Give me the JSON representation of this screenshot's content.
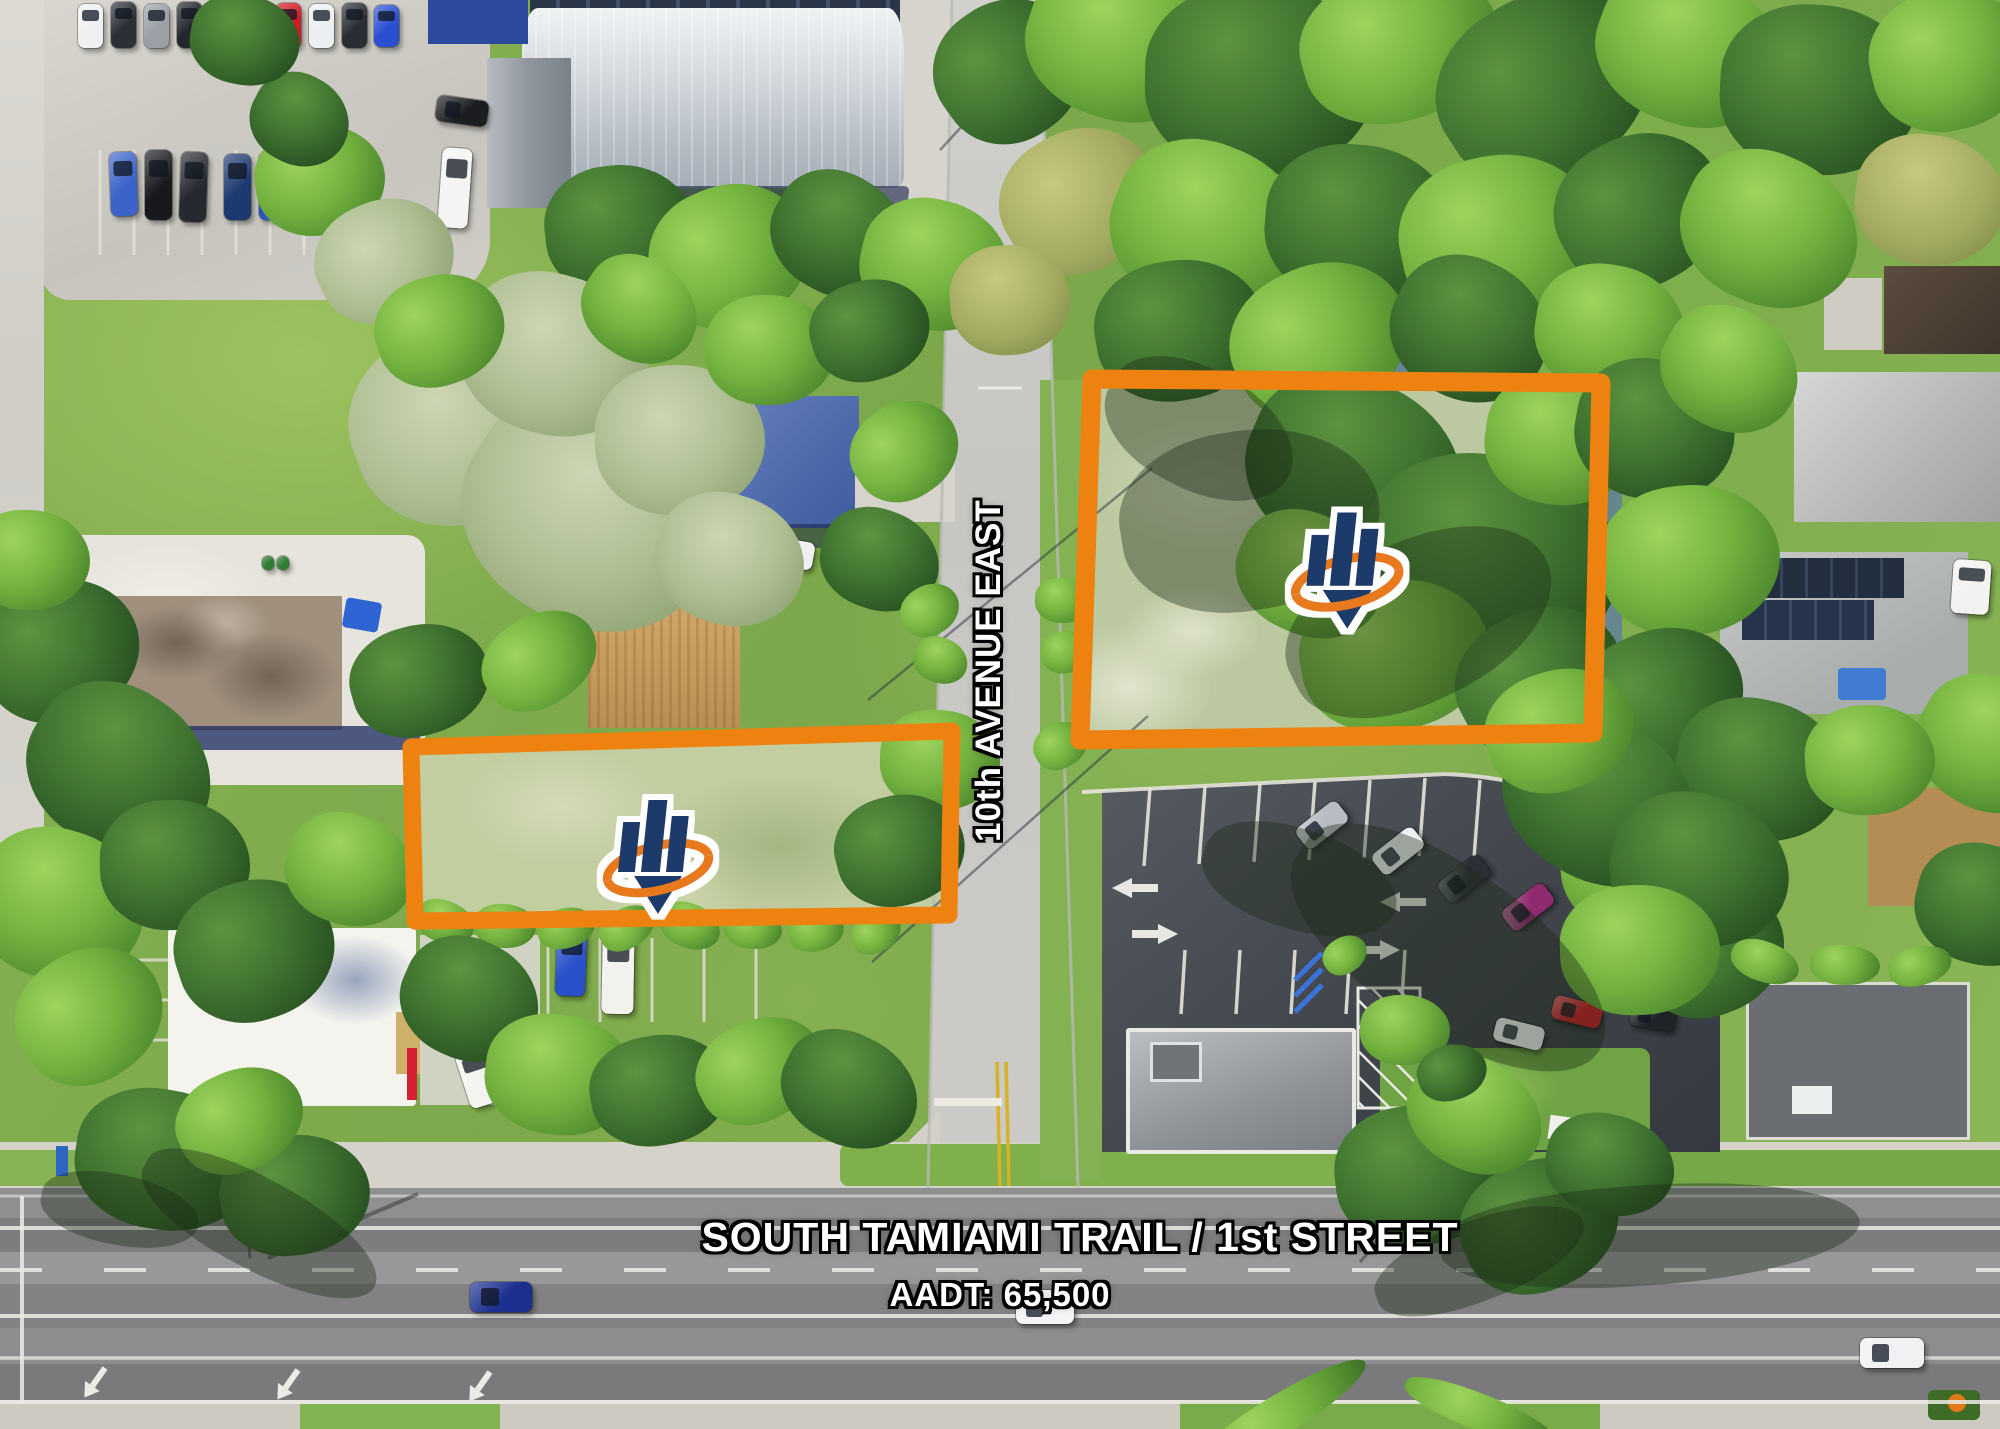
{
  "image": {
    "type": "aerial-drone-photo",
    "subject": "Two vacant land parcels outlined in orange at 10th Avenue East and South Tamiami Trail"
  },
  "labels": {
    "cross_street": "10th AVENUE EAST",
    "main_road": "SOUTH TAMIAMI TRAIL / 1st STREET",
    "traffic_count": "AADT: 65,500",
    "aadt_value": "65,500"
  },
  "parcels": [
    {
      "name": "west-parcel",
      "outlined": true,
      "marker": "company-logo-pin"
    },
    {
      "name": "east-parcel",
      "outlined": true,
      "marker": "company-logo-pin"
    }
  ],
  "icons": {
    "company_logo_pin": "bar-chart-with-orange-swoosh-location-pin"
  },
  "colors": {
    "parcel_outline": "#ee8211",
    "logo_navy": "#1e3a6a",
    "logo_orange": "#e8791f",
    "label_fill": "#ffffff",
    "label_outline": "#000000"
  }
}
